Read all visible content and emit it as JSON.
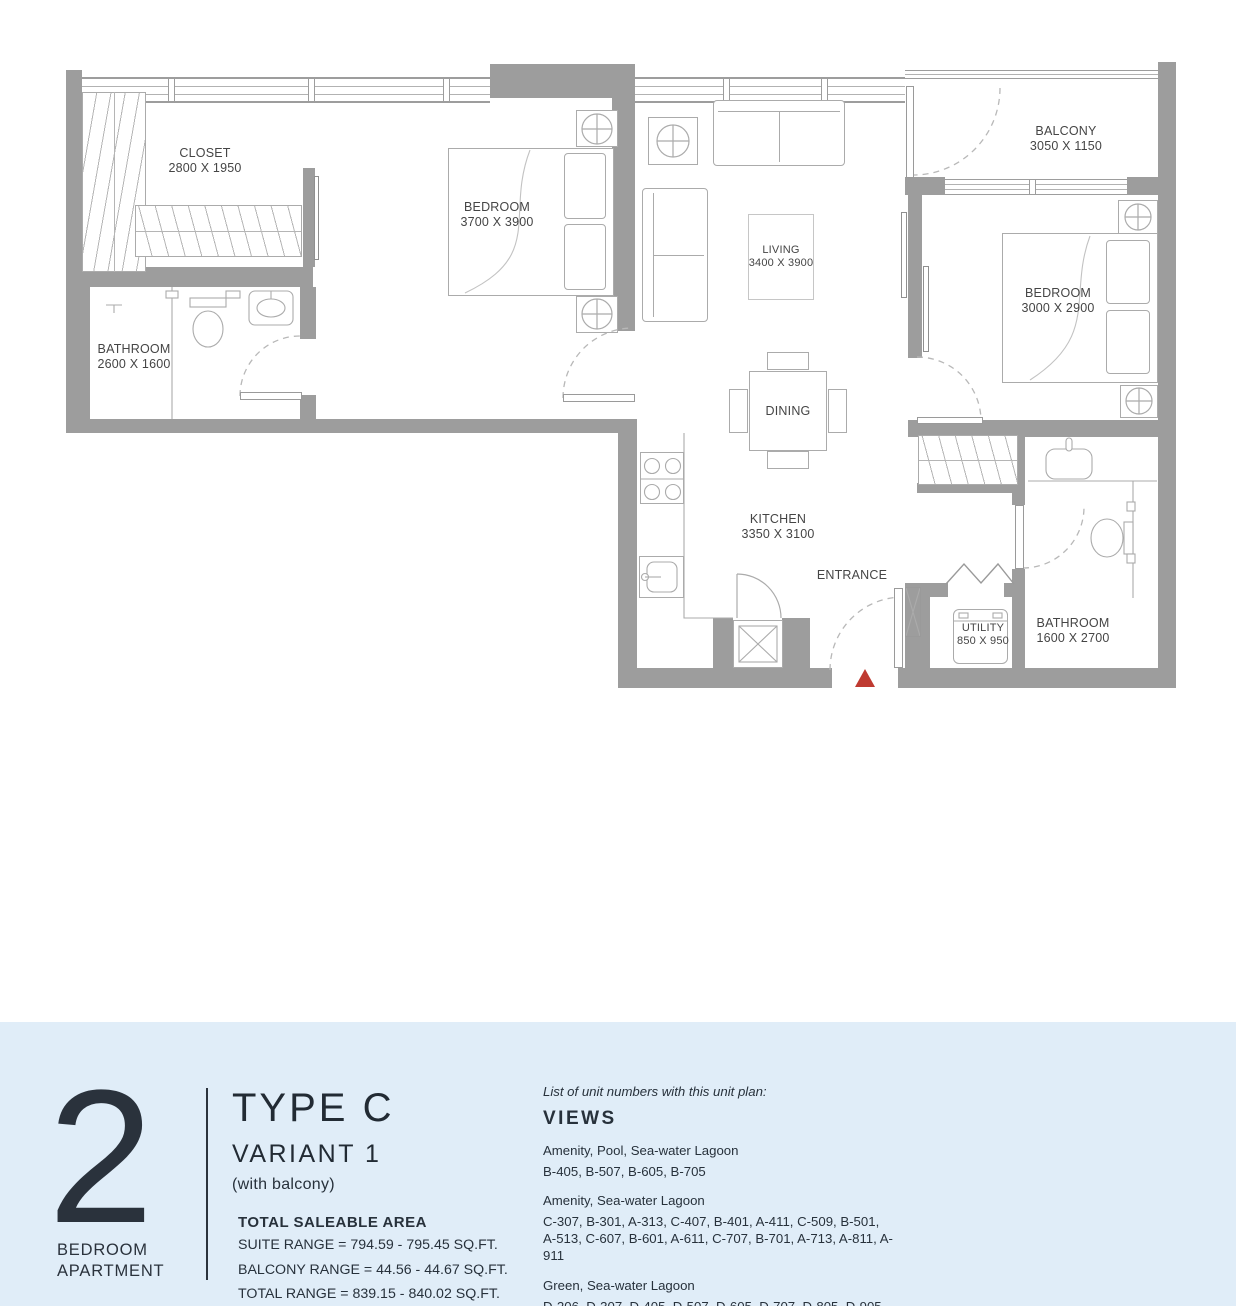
{
  "plan": {
    "rooms": {
      "closet": {
        "name": "CLOSET",
        "dims": "2800 X 1950"
      },
      "bedroom1": {
        "name": "BEDROOM",
        "dims": "3700 X 3900"
      },
      "living": {
        "name": "LIVING",
        "dims": "3400 X 3900"
      },
      "balcony": {
        "name": "BALCONY",
        "dims": "3050 X 1150"
      },
      "bedroom2": {
        "name": "BEDROOM",
        "dims": "3000 X 2900"
      },
      "bathroom1": {
        "name": "BATHROOM",
        "dims": "2600 X 1600"
      },
      "dining": {
        "name": "DINING"
      },
      "kitchen": {
        "name": "KITCHEN",
        "dims": "3350 X 3100"
      },
      "entrance": {
        "name": "ENTRANCE"
      },
      "utility": {
        "name": "UTILITY",
        "dims": "850 X 950"
      },
      "bathroom2": {
        "name": "BATHROOM",
        "dims": "1600 X 2700"
      }
    },
    "colors": {
      "wall": "#9d9d9d",
      "entrance_marker": "#bf3a31"
    }
  },
  "info_panel": {
    "bedrooms_number": "2",
    "bedrooms_label_line1": "BEDROOM",
    "bedrooms_label_line2": "APARTMENT",
    "type_title": "TYPE C",
    "variant": "VARIANT 1",
    "variant_note": "(with balcony)",
    "area_title": "TOTAL SALEABLE AREA",
    "area_lines": [
      "SUITE RANGE = 794.59 - 795.45 SQ.FT.",
      "BALCONY RANGE = 44.56 - 44.67 SQ.FT.",
      "TOTAL RANGE = 839.15 - 840.02 SQ.FT."
    ],
    "views": {
      "intro": "List of unit numbers with this unit plan:",
      "title": "VIEWS",
      "groups": [
        {
          "view": "Amenity, Pool, Sea-water Lagoon",
          "units": "B-405, B-507, B-605, B-705"
        },
        {
          "view": "Amenity, Sea-water Lagoon",
          "units": "C-307, B-301, A-313, C-407, B-401, A-411, C-509, B-501, A-513, C-607, B-601, A-611, C-707, B-701, A-713, A-811, A-911"
        },
        {
          "view": "Green, Sea-water Lagoon",
          "units": "D-206, D-307, D-405, D-507, D-605, D-707, D-805, D-905"
        }
      ]
    }
  }
}
